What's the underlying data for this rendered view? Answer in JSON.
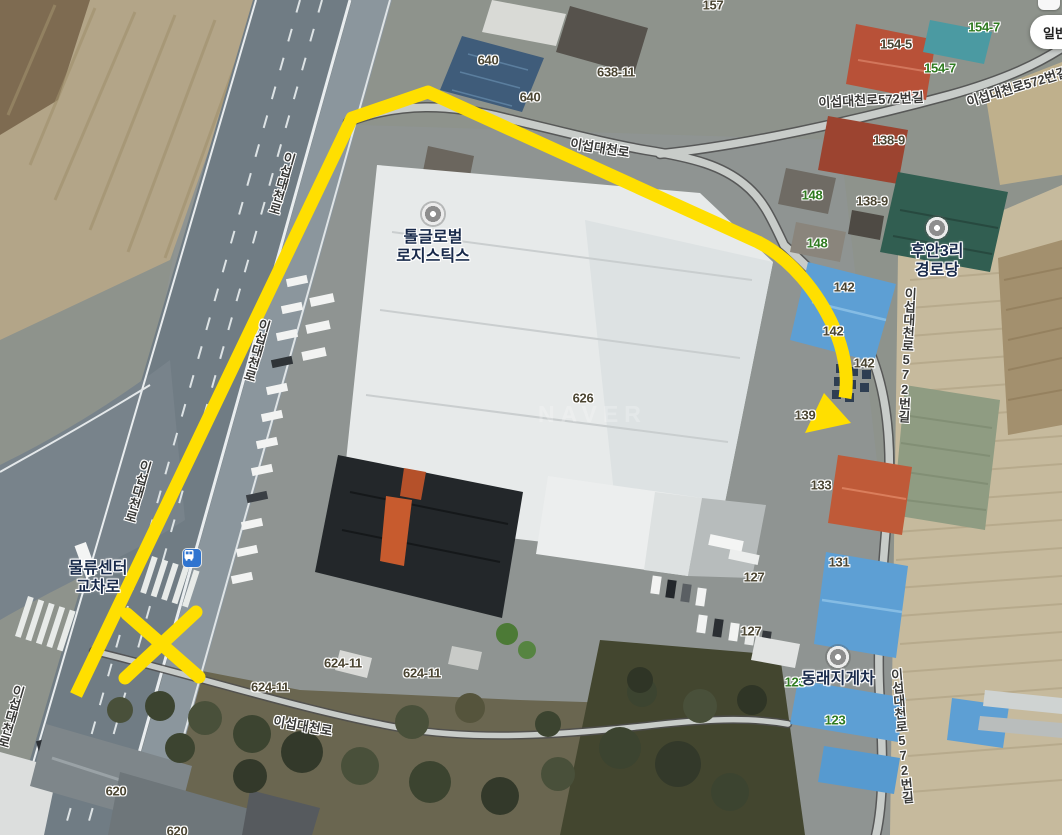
{
  "app": {
    "map_type_button": "일반",
    "watermark": "NAVER"
  },
  "map": {
    "pois": [
      {
        "lines": [
          "톨글로벌",
          "로지스틱스"
        ],
        "x": 433,
        "y": 214,
        "marker": true
      },
      {
        "lines": [
          "후안3리",
          "경로당"
        ],
        "x": 937,
        "y": 228,
        "marker": true
      },
      {
        "lines": [
          "동래지게차"
        ],
        "x": 838,
        "y": 657,
        "marker": true
      },
      {
        "lines": [
          "물류센터",
          "교차로"
        ],
        "x": 98,
        "y": 578,
        "marker": false
      }
    ],
    "road_labels": [
      {
        "text": "이섭대천로",
        "x": 600,
        "y": 147,
        "rot": 9,
        "v": false
      },
      {
        "text": "이섭대천로572번길",
        "x": 871,
        "y": 99,
        "rot": -3,
        "v": false
      },
      {
        "text": "이섭대천로572번길",
        "x": 1017,
        "y": 86,
        "rot": -17,
        "v": false
      },
      {
        "text": "이섭대천로572번길",
        "x": 906,
        "y": 355,
        "rot": 3,
        "v": true
      },
      {
        "text": "이섭대천로572번길",
        "x": 901,
        "y": 736,
        "rot": -5,
        "v": true
      },
      {
        "text": "이섭대천로",
        "x": 281,
        "y": 183,
        "rot": 16,
        "v": true
      },
      {
        "text": "이섭대천로",
        "x": 256,
        "y": 350,
        "rot": 16,
        "v": true
      },
      {
        "text": "이섭대천로",
        "x": 137,
        "y": 491,
        "rot": 16,
        "v": true
      },
      {
        "text": "이섭대천로",
        "x": 10,
        "y": 716,
        "rot": 16,
        "v": true
      },
      {
        "text": "이섭대천로",
        "x": 303,
        "y": 725,
        "rot": 10,
        "v": false
      }
    ],
    "parcel_labels": [
      {
        "text": "157",
        "x": 713,
        "y": 5,
        "c": "dark"
      },
      {
        "text": "640",
        "x": 488,
        "y": 60,
        "c": "dark"
      },
      {
        "text": "638-11",
        "x": 616,
        "y": 72,
        "c": "dark"
      },
      {
        "text": "640",
        "x": 530,
        "y": 97,
        "c": "dark"
      },
      {
        "text": "154-5",
        "x": 896,
        "y": 44,
        "c": "dark"
      },
      {
        "text": "154-7",
        "x": 940,
        "y": 68,
        "c": "green"
      },
      {
        "text": "154-7",
        "x": 984,
        "y": 27,
        "c": "green"
      },
      {
        "text": "138-9",
        "x": 889,
        "y": 140,
        "c": "dark"
      },
      {
        "text": "138-9",
        "x": 872,
        "y": 201,
        "c": "dark"
      },
      {
        "text": "148",
        "x": 812,
        "y": 195,
        "c": "green"
      },
      {
        "text": "148",
        "x": 817,
        "y": 243,
        "c": "green"
      },
      {
        "text": "142",
        "x": 844,
        "y": 287,
        "c": "dark"
      },
      {
        "text": "142",
        "x": 833,
        "y": 331,
        "c": "dark"
      },
      {
        "text": "142",
        "x": 864,
        "y": 363,
        "c": "dark"
      },
      {
        "text": "139",
        "x": 805,
        "y": 415,
        "c": "dark"
      },
      {
        "text": "626",
        "x": 583,
        "y": 398,
        "c": "dark"
      },
      {
        "text": "133",
        "x": 821,
        "y": 485,
        "c": "dark"
      },
      {
        "text": "131",
        "x": 839,
        "y": 562,
        "c": "dark"
      },
      {
        "text": "127",
        "x": 754,
        "y": 577,
        "c": "dark"
      },
      {
        "text": "127",
        "x": 751,
        "y": 631,
        "c": "dark"
      },
      {
        "text": "123",
        "x": 795,
        "y": 682,
        "c": "green"
      },
      {
        "text": "123",
        "x": 835,
        "y": 720,
        "c": "green"
      },
      {
        "text": "624-11",
        "x": 343,
        "y": 663,
        "c": "dark"
      },
      {
        "text": "624-11",
        "x": 422,
        "y": 673,
        "c": "dark"
      },
      {
        "text": "624-11",
        "x": 270,
        "y": 687,
        "c": "dark"
      },
      {
        "text": "620",
        "x": 116,
        "y": 791,
        "c": "dark"
      },
      {
        "text": "620",
        "x": 177,
        "y": 831,
        "c": "dark"
      }
    ],
    "annotation": {
      "color": "#ffdf00",
      "route_path": "M76,695 L352,118 L428,92 L758,242 C790,258 818,292 834,328 C843,348 849,374 845,398",
      "arrow_points": "805,433 824,393 851,423",
      "x_stroke_1": "M127,614 L199,677",
      "x_stroke_2": "M196,612 L125,678"
    },
    "icons": {
      "bus_stop": {
        "x": 192,
        "y": 558
      }
    }
  }
}
